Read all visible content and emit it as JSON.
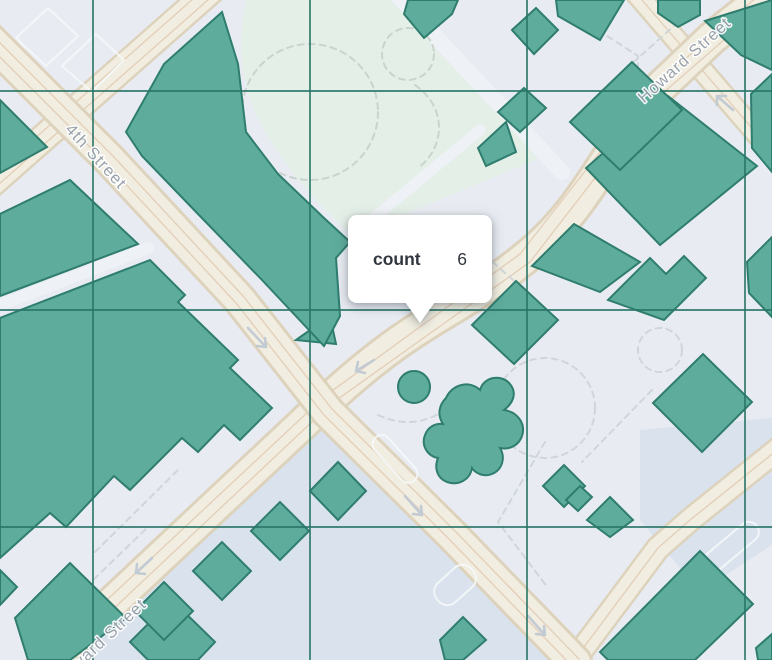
{
  "tooltip": {
    "field": "count",
    "value": "6"
  },
  "street_labels": {
    "fourth": "4th Street",
    "howard_ne": "Howard Street",
    "howard_sw": "Howard Street"
  },
  "grid": {
    "vertical_x": [
      93,
      310,
      527,
      745
    ],
    "horizontal_y": [
      91,
      310,
      527
    ]
  },
  "icons": [
    "one-way-arrow-icon",
    "tooltip-caret-icon"
  ],
  "colors": {
    "lot": "#e8ecf2",
    "lot_ghost": "#f5f8fa",
    "park": "#e4efe8",
    "water_zone": "#d6e1ec",
    "street": "#f1eee1",
    "street_edge": "#ddd2bc",
    "street_line": "#e3cfba",
    "street_minor": "#eef1f5",
    "building": "#5dac9c",
    "building_line": "#2f7d6e",
    "grid": "#2a7668",
    "label": "#939da8",
    "path_dash": "#cfd6da",
    "park_dash": "#c9d4ce",
    "arrow": "#c2cad3",
    "tooltip_bg": "#ffffff",
    "tooltip_text": "#31373e"
  }
}
